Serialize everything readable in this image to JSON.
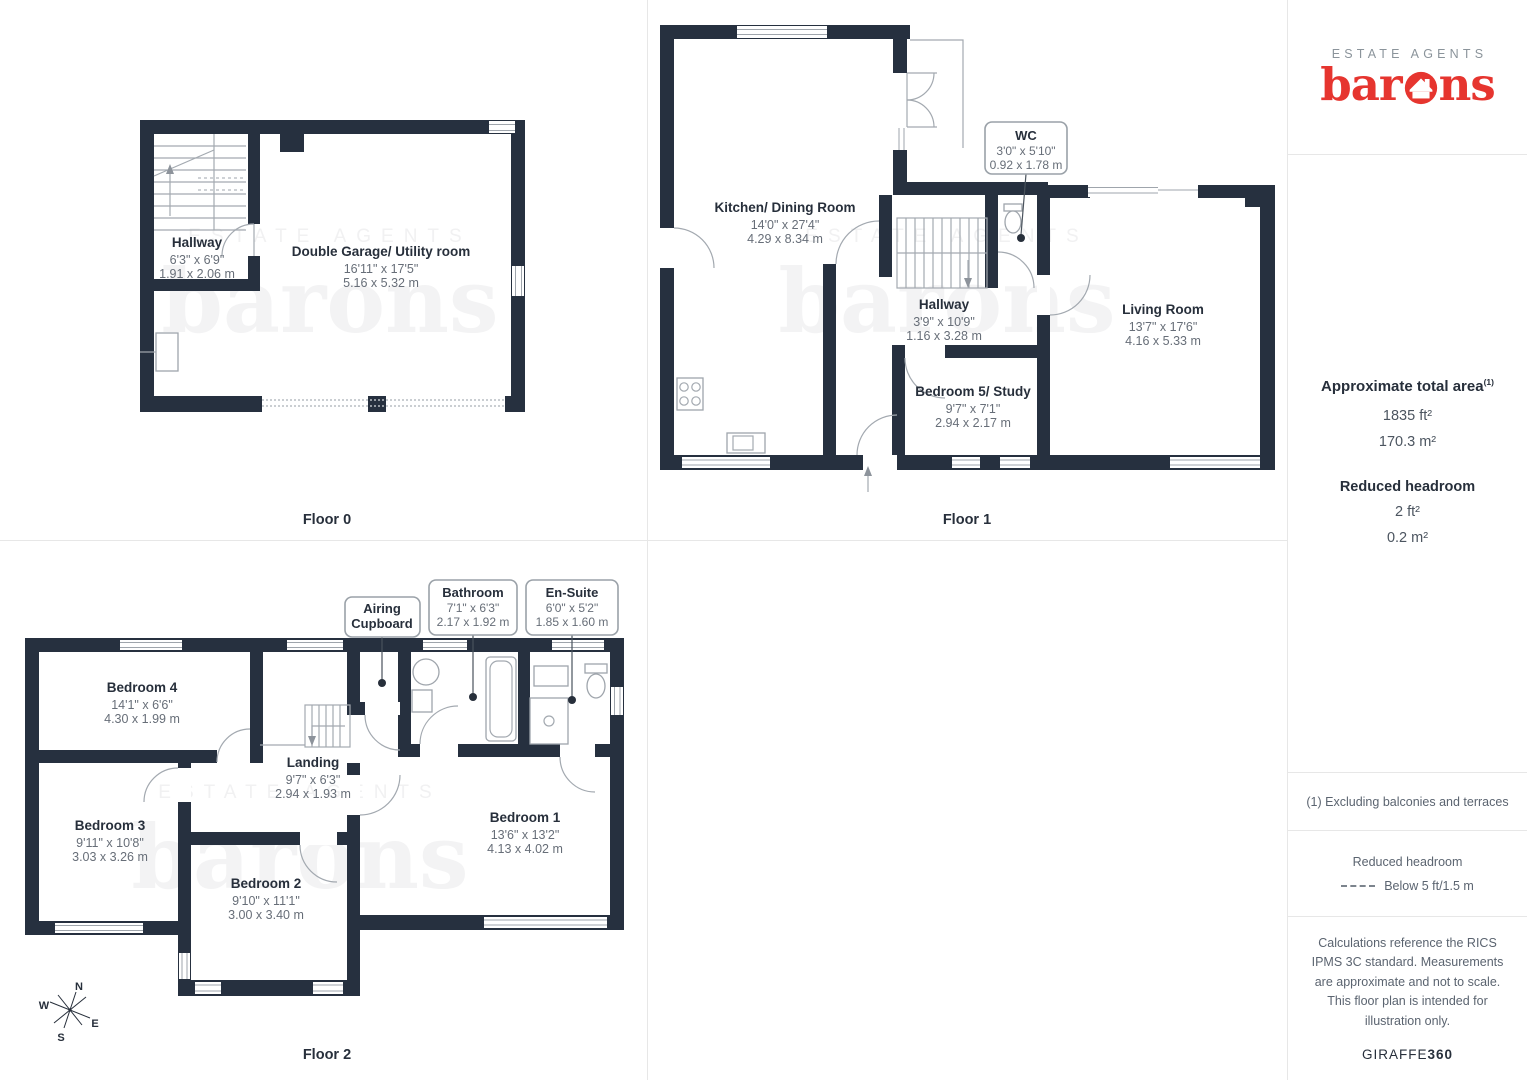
{
  "branding": {
    "tagline": "ESTATE AGENTS",
    "brand": "barons",
    "brand_prefix": "bar",
    "brand_suffix": "ns",
    "brand_color": "#e6352f",
    "tagline_color": "#8b949b",
    "wall_color": "#26303f"
  },
  "floors": {
    "floor0": {
      "label": "Floor 0",
      "rooms": {
        "hallway": {
          "name": "Hallway",
          "dims_ft": "6'3\" x 6'9\"",
          "dims_m": "1.91 x 2.06 m"
        },
        "garage": {
          "name": "Double Garage/ Utility room",
          "dims_ft": "16'11\" x 17'5\"",
          "dims_m": "5.16 x 5.32 m"
        }
      }
    },
    "floor1": {
      "label": "Floor 1",
      "rooms": {
        "kitchen": {
          "name": "Kitchen/ Dining Room",
          "dims_ft": "14'0\" x 27'4\"",
          "dims_m": "4.29 x 8.34 m"
        },
        "wc": {
          "name": "WC",
          "dims_ft": "3'0\" x 5'10\"",
          "dims_m": "0.92 x 1.78 m"
        },
        "hallway": {
          "name": "Hallway",
          "dims_ft": "3'9\" x 10'9\"",
          "dims_m": "1.16 x 3.28 m"
        },
        "living": {
          "name": "Living Room",
          "dims_ft": "13'7\" x 17'6\"",
          "dims_m": "4.16 x 5.33 m"
        },
        "bedroom5": {
          "name": "Bedroom 5/ Study",
          "dims_ft": "9'7\" x 7'1\"",
          "dims_m": "2.94 x 2.17 m"
        }
      }
    },
    "floor2": {
      "label": "Floor 2",
      "rooms": {
        "bedroom4": {
          "name": "Bedroom 4",
          "dims_ft": "14'1\" x 6'6\"",
          "dims_m": "4.30 x 1.99 m"
        },
        "bedroom3": {
          "name": "Bedroom 3",
          "dims_ft": "9'11\" x 10'8\"",
          "dims_m": "3.03 x 3.26 m"
        },
        "landing": {
          "name": "Landing",
          "dims_ft": "9'7\" x 6'3\"",
          "dims_m": "2.94 x 1.93 m"
        },
        "bedroom2": {
          "name": "Bedroom 2",
          "dims_ft": "9'10\" x 11'1\"",
          "dims_m": "3.00 x 3.40 m"
        },
        "bedroom1": {
          "name": "Bedroom 1",
          "dims_ft": "13'6\" x 13'2\"",
          "dims_m": "4.13 x 4.02 m"
        },
        "airing": {
          "name_line1": "Airing",
          "name_line2": "Cupboard"
        },
        "bathroom": {
          "name": "Bathroom",
          "dims_ft": "7'1\" x 6'3\"",
          "dims_m": "2.17 x 1.92 m"
        },
        "ensuite": {
          "name": "En-Suite",
          "dims_ft": "6'0\" x 5'2\"",
          "dims_m": "1.85 x 1.60 m"
        }
      }
    }
  },
  "compass": {
    "n": "N",
    "e": "E",
    "s": "S",
    "w": "W"
  },
  "sidebar": {
    "total_area_title": "Approximate total area",
    "total_area_marker": "(1)",
    "total_area_ft": "1835 ft²",
    "total_area_m": "170.3 m²",
    "reduced_title": "Reduced headroom",
    "reduced_ft": "2 ft²",
    "reduced_m": "0.2 m²",
    "footnote": "(1) Excluding balconies and terraces",
    "legend_title": "Reduced headroom",
    "legend_item": "Below 5 ft/1.5 m",
    "disclaimer": "Calculations reference the RICS IPMS 3C standard. Measurements are approximate and not to scale. This floor plan is intended for illustration only.",
    "credit_normal": "GIRAFFE",
    "credit_bold": "360"
  }
}
